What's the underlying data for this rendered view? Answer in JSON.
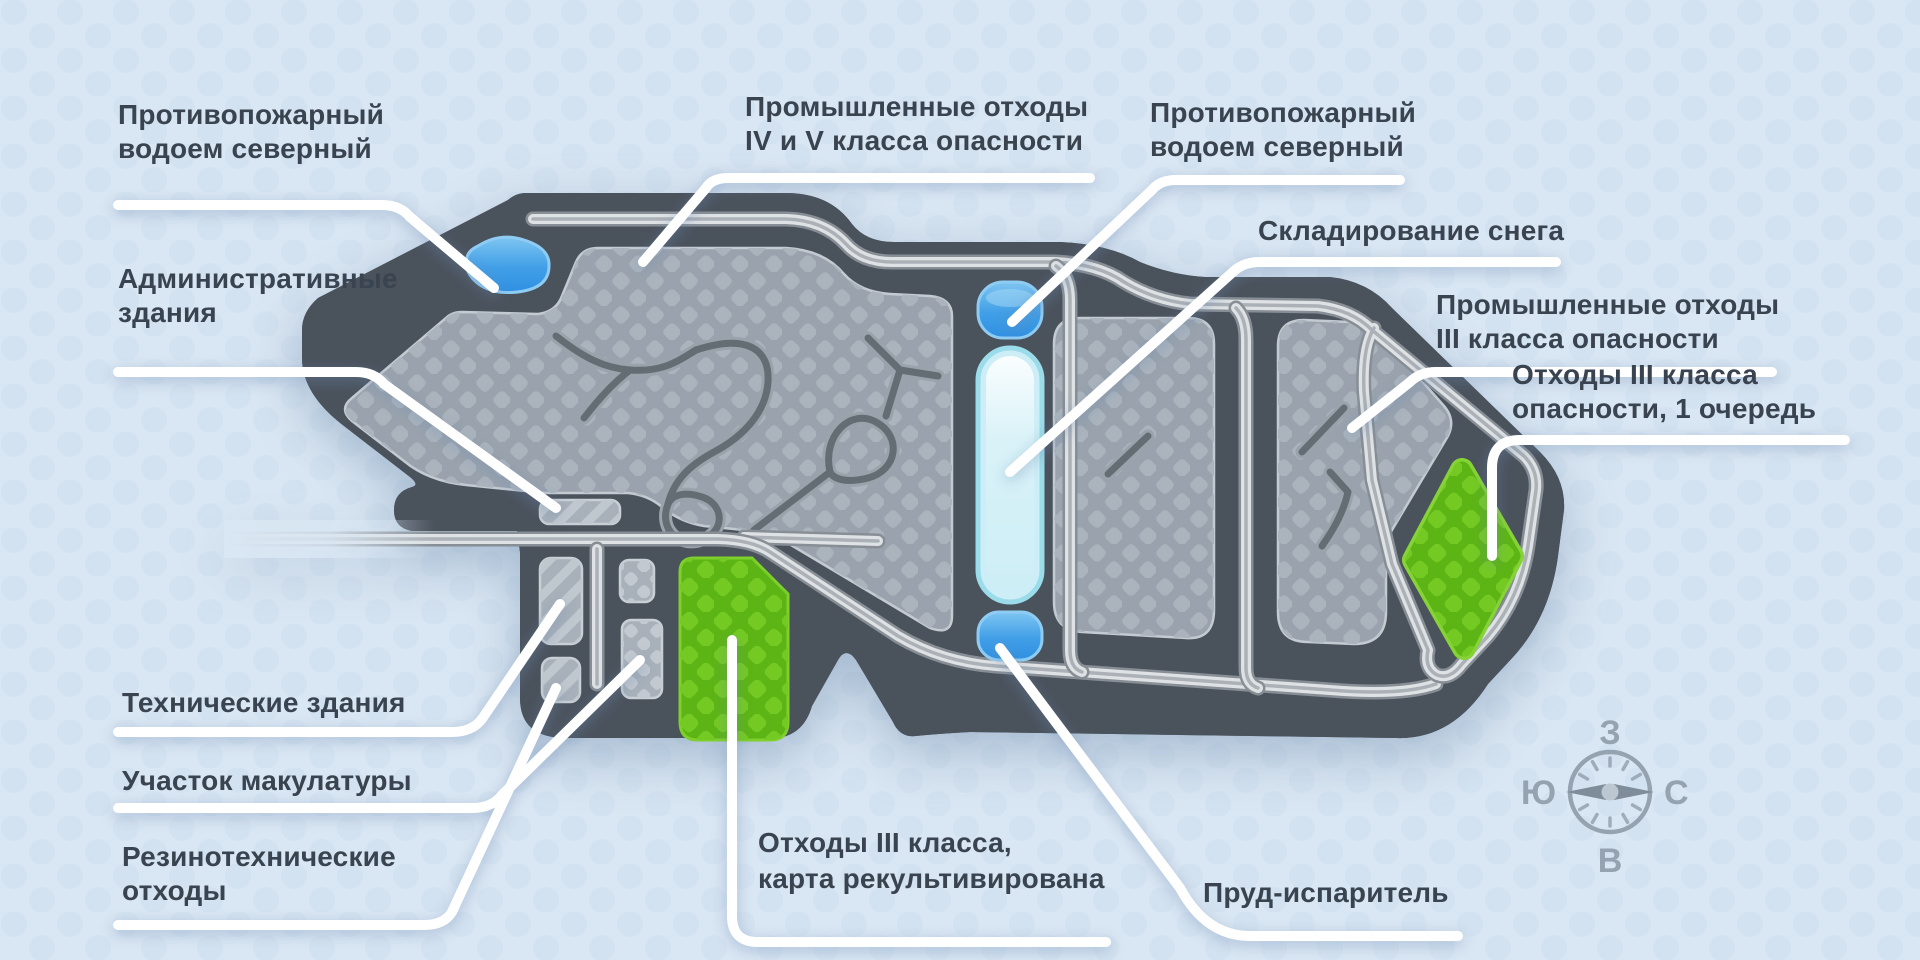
{
  "figure": {
    "type": "illustrated-site-map",
    "language": "ru",
    "background_color": "#d9e6f3"
  },
  "labels": [
    {
      "id": "fire-reservoir-north-west",
      "lines": [
        "Противопожарный",
        "водоем северный"
      ]
    },
    {
      "id": "admin-buildings",
      "lines": [
        "Административные",
        "здания"
      ]
    },
    {
      "id": "industrial-waste-4-5",
      "lines": [
        "Промышленные отходы",
        "IV и V класса опасности"
      ]
    },
    {
      "id": "fire-reservoir-north",
      "lines": [
        "Противопожарный",
        "водоем северный"
      ]
    },
    {
      "id": "snow-storage",
      "lines": [
        "Складирование снега"
      ]
    },
    {
      "id": "industrial-waste-3",
      "lines": [
        "Промышленные отходы",
        "III класса опасности"
      ]
    },
    {
      "id": "waste-3-stage-1",
      "lines": [
        "Отходы III класса",
        "опасности, 1 очередь"
      ]
    },
    {
      "id": "technical-buildings",
      "lines": [
        "Технические здания"
      ]
    },
    {
      "id": "paper-recycling-area",
      "lines": [
        "Участок макулатуры"
      ]
    },
    {
      "id": "rubber-waste",
      "lines": [
        "Резинотехнические",
        "отходы"
      ]
    },
    {
      "id": "waste-3-recultivated",
      "lines": [
        "Отходы III класса,",
        "карта рекультивирована"
      ]
    },
    {
      "id": "evaporation-pond",
      "lines": [
        "Пруд-испаритель"
      ]
    }
  ],
  "compass": {
    "west": "З",
    "south": "Ю",
    "north": "С",
    "east": "В"
  },
  "palette": {
    "background": "#d9e6f3",
    "background_dots": "#cddded",
    "dark_band": "#4a525c",
    "dark_band_stripe": "#575f69",
    "section_fill": "#9aa3ad",
    "section_diamond": "#abb4bd",
    "road_fill": "#dfe2e4",
    "road_casing": "#878e95",
    "pond_blue": "#2f90e2",
    "pond_blue_light": "#7ec5f1",
    "snow_strip": "#cdeef6",
    "snow_strip_border": "#9bdcea",
    "green_area": "#5cb514",
    "green_area_diamond": "#74ca22",
    "label_text": "#3a4450",
    "leader_line": "#ffffff",
    "compass": "#95a2b0"
  }
}
